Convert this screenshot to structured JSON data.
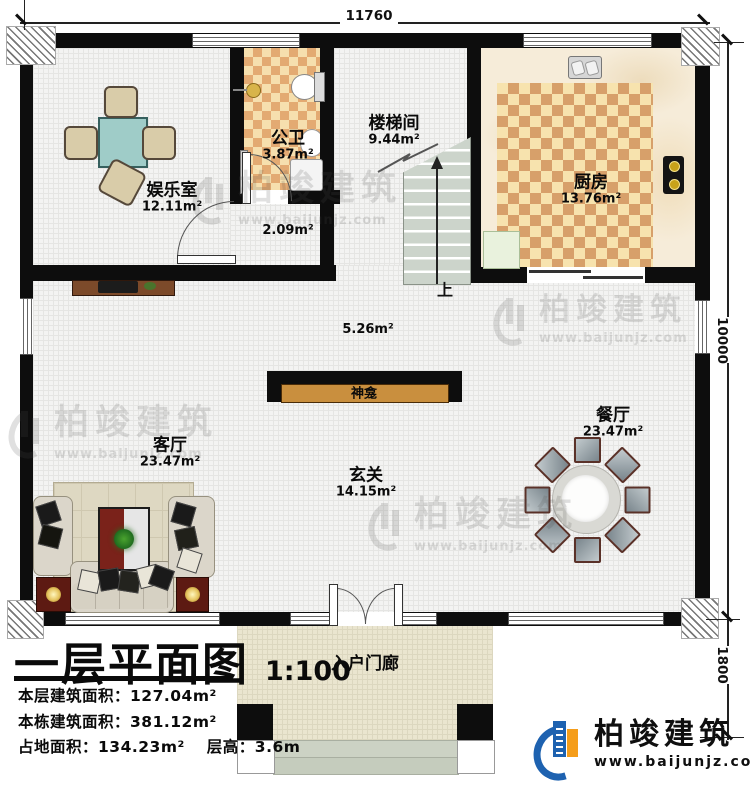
{
  "dimensions": {
    "top": "11760",
    "right_upper": "10000",
    "right_lower": "1800"
  },
  "rooms": {
    "entertainment": {
      "name": "娱乐室",
      "area": "12.11m²"
    },
    "bathroom": {
      "name": "公卫",
      "area": "3.87m²"
    },
    "stairwell": {
      "name": "楼梯间",
      "area": "9.44m²"
    },
    "kitchen": {
      "name": "厨房",
      "area": "13.76m²"
    },
    "hallway": {
      "area": "2.09m²"
    },
    "rear_hall": {
      "area": "5.26m²"
    },
    "living": {
      "name": "客厅",
      "area": "23.47m²"
    },
    "foyer": {
      "name": "玄关",
      "area": "14.15m²"
    },
    "dining": {
      "name": "餐厅",
      "area": "23.47m²"
    },
    "porch": {
      "name": "入户门廊"
    }
  },
  "features": {
    "shrine": "神龛",
    "stairs_up": "上"
  },
  "title_block": {
    "title": "一层平面图",
    "scale": "1:100",
    "stats": [
      {
        "label": "本层建筑面积：",
        "value": "127.04m²"
      },
      {
        "label": "本栋建筑面积：",
        "value": "381.12m²"
      },
      {
        "label": "占地面积：",
        "value": "134.23m²"
      },
      {
        "label": "层高：",
        "value": "3.6m"
      }
    ]
  },
  "branding": {
    "company": "柏竣建筑",
    "website": "www.baijunjz.com"
  },
  "watermark": {
    "company": "柏竣建筑",
    "website": "www.baijunjz.com"
  },
  "colors": {
    "wall": "#0d0d0d",
    "tile_dark": "#d7a06a",
    "tile_light": "#f7e3ae",
    "logo_blue": "#1e62b0",
    "logo_orange": "#f59d1a",
    "shrine_shelf": "#c98f3e",
    "table_teal": "#9fccc8"
  }
}
